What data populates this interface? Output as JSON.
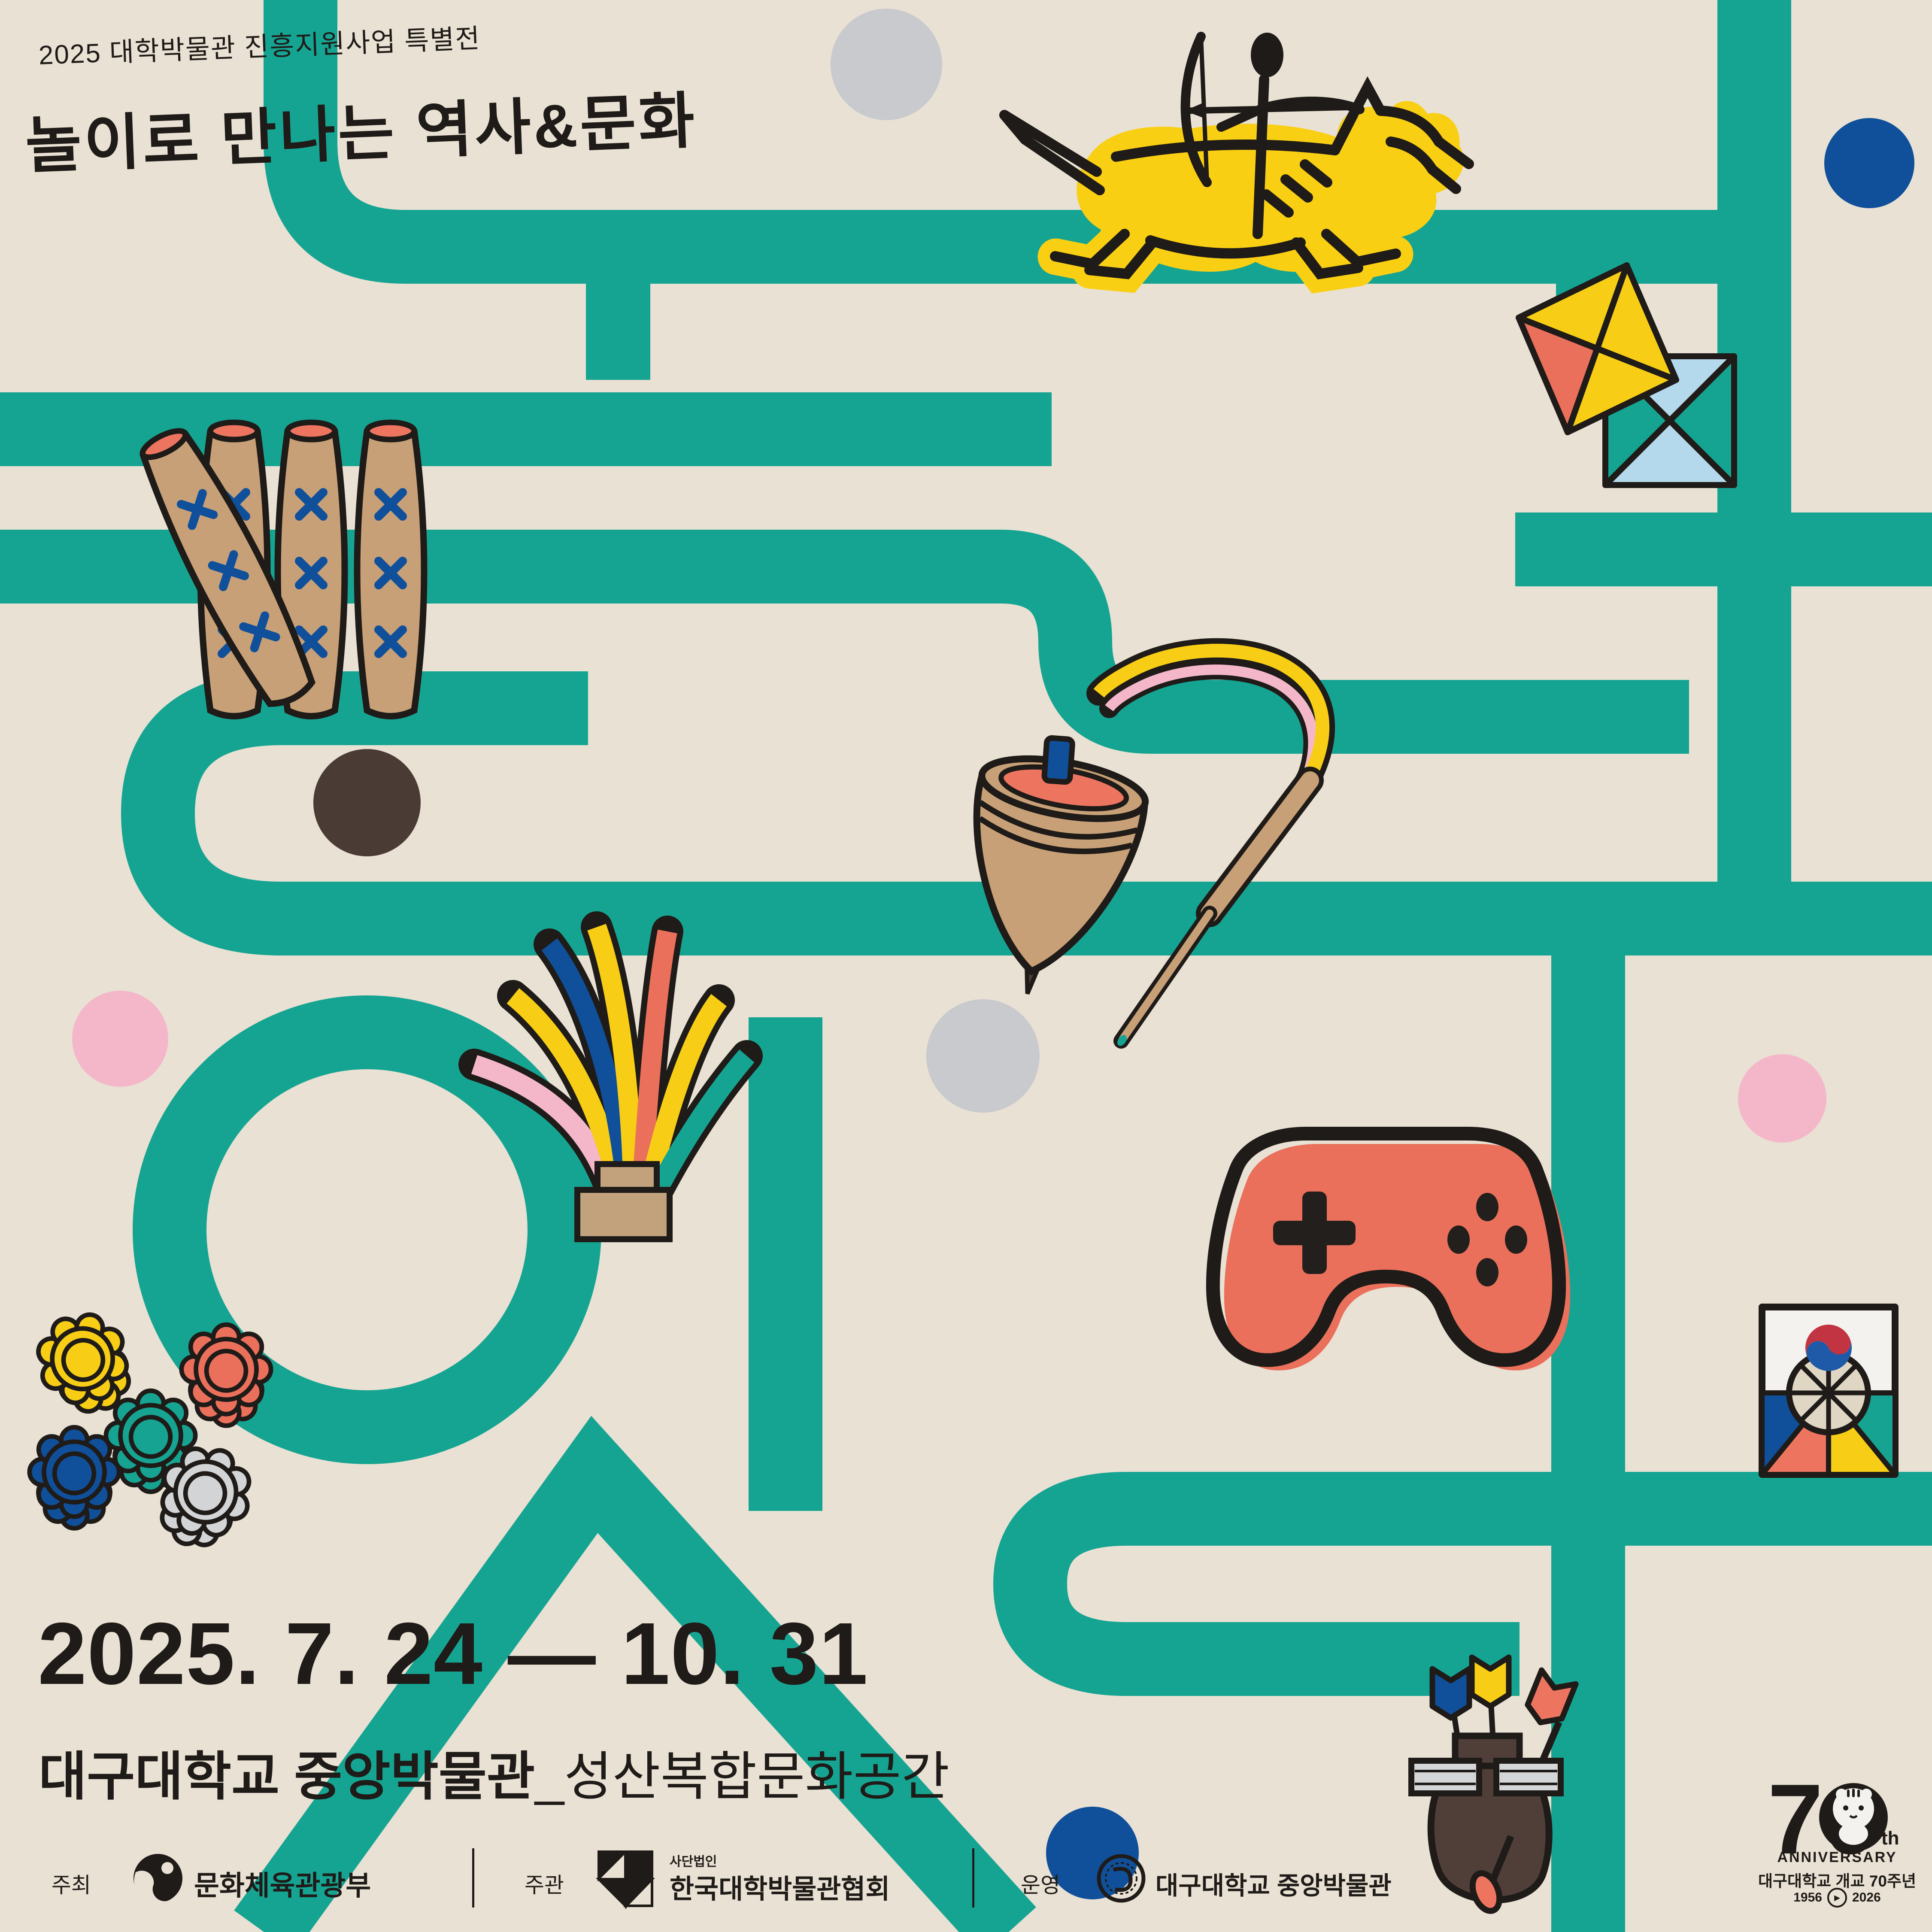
{
  "poster": {
    "badge": "2025 대학박물관 진흥지원사업 특별전",
    "title": "놀이로 만나는 역사&문화",
    "date_range": "2025. 7. 24 — 10. 31",
    "venue_main": "대구대학교 중앙박물관",
    "venue_sub": "_성산복합문화공간"
  },
  "footer": {
    "host_label": "주최",
    "host_name": "문화체육관광부",
    "organizer_label": "주관",
    "organizer_prefix": "사단법인",
    "organizer_name": "한국대학박물관협회",
    "operator_label": "운영",
    "operator_name": "대구대학교 중앙박물관"
  },
  "anniversary": {
    "number": "70",
    "suffix": "th",
    "word": "ANNIVERSARY",
    "caption": "대구대학교 개교 70주년",
    "year_from": "1956",
    "year_to": "2026",
    "play_glyph": "▶"
  },
  "icons": {
    "maze-path": "teal maze lines forming hangul-like paths",
    "horse-archer-icon": "yellow galloping horse with stick-figure mounted archer (Goguryeo hunting mural style)",
    "kite-pair-icon": "two traditional kites, yellow/red diamond and blue/teal square",
    "yut-sticks-icon": "four yut game sticks with blue X marks",
    "spinning-top-icon": "wooden spinning top (paengi) with whip and yellow-pink ribbon",
    "jegi-icon": "jegichagi shuttlecock with colorful ribbons",
    "game-controller-icon": "red video game controller with d-pad and buttons",
    "flower-tokens-icon": "five flower-shaped game pieces (yellow, red, teal, blue, gray)",
    "shield-kite-icon": "Korean shield kite (bangpaeyeon) with taegeuk",
    "tuho-icon": "brown tuho pot with blue, yellow and red arrows",
    "ministry-logo": "Ministry of Culture, Sports and Tourism emblem",
    "association-logo": "Korean Association of University Museums emblem",
    "university-seal": "Daegu University seal",
    "tiger-mascot-icon": "white tiger mascot inside the 0 of 70"
  },
  "colors": {
    "background": "#E9E1D3",
    "teal": "#16A492",
    "ink": "#1F1B18",
    "yellow": "#F7CE15",
    "salmon": "#EA705B",
    "pink": "#F4B7CA",
    "blue": "#10509B",
    "light_blue": "#B5D9EC",
    "tan": "#C7A077",
    "brown": "#4F3F38",
    "gray": "#C9CACE"
  }
}
